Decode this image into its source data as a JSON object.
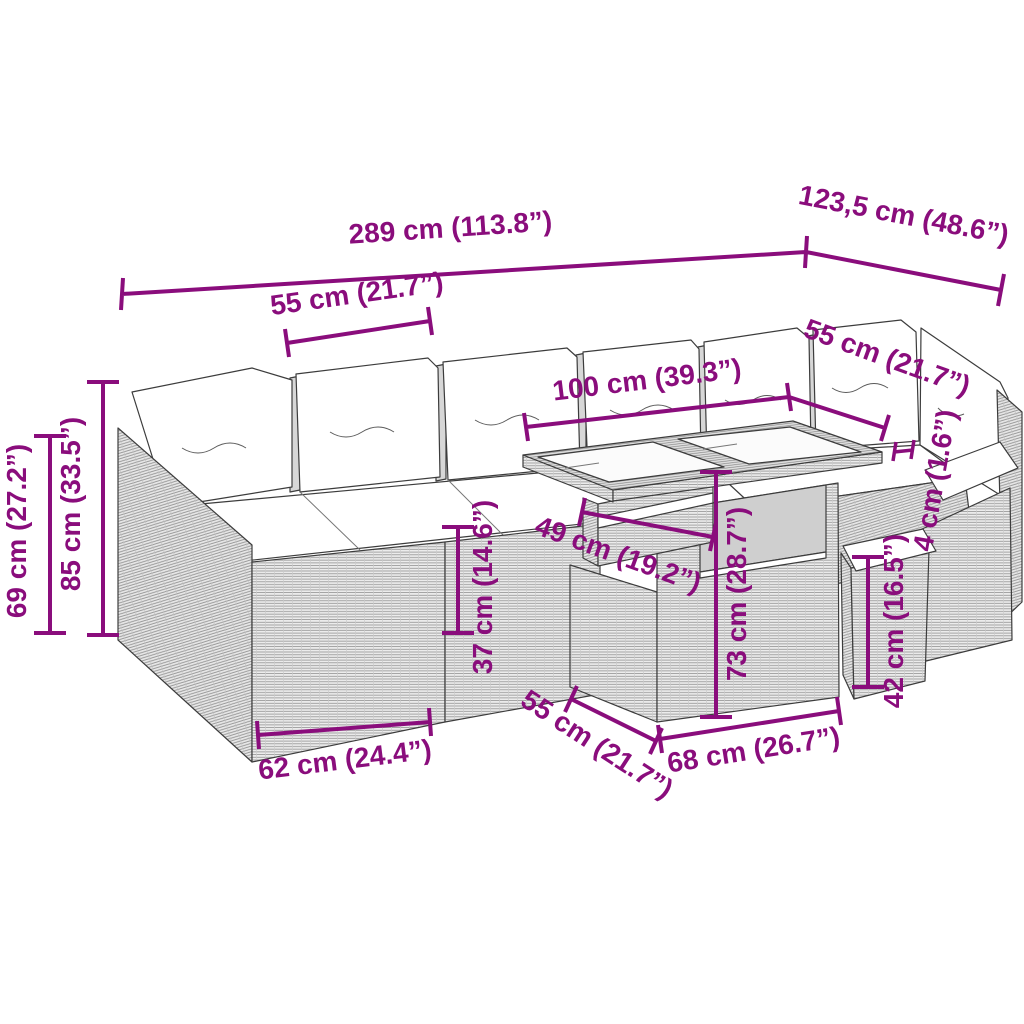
{
  "title": "Garden lounge set dimension diagram",
  "colors": {
    "dimension": "#8A0D7C",
    "line_art": "#3C3C3C",
    "cushion": "#FFFFFF",
    "background": "#FFFFFF"
  },
  "labels": {
    "overall_width": "289 cm (113.8”)",
    "overall_depth": "123,5 cm (48.6”)",
    "module_width_top": "55 cm (21.7”)",
    "table_length": "100 cm (39.3”)",
    "module_width_right": "55 cm (21.7”)",
    "back_height": "69 cm (27.2”)",
    "total_height": "85 cm (33.5”)",
    "seat_height": "37 cm (14.6”)",
    "shelf_width": "49 cm (19.2”)",
    "table_height": "73 cm (28.7”)",
    "top_thickness": "4 cm (1.6”)",
    "stool_height": "42 cm (16.5”)",
    "corner_module_width": "62 cm (24.4”)",
    "table_base_depth": "55 cm (21.7”)",
    "table_base_width": "68 cm (26.7”)"
  }
}
